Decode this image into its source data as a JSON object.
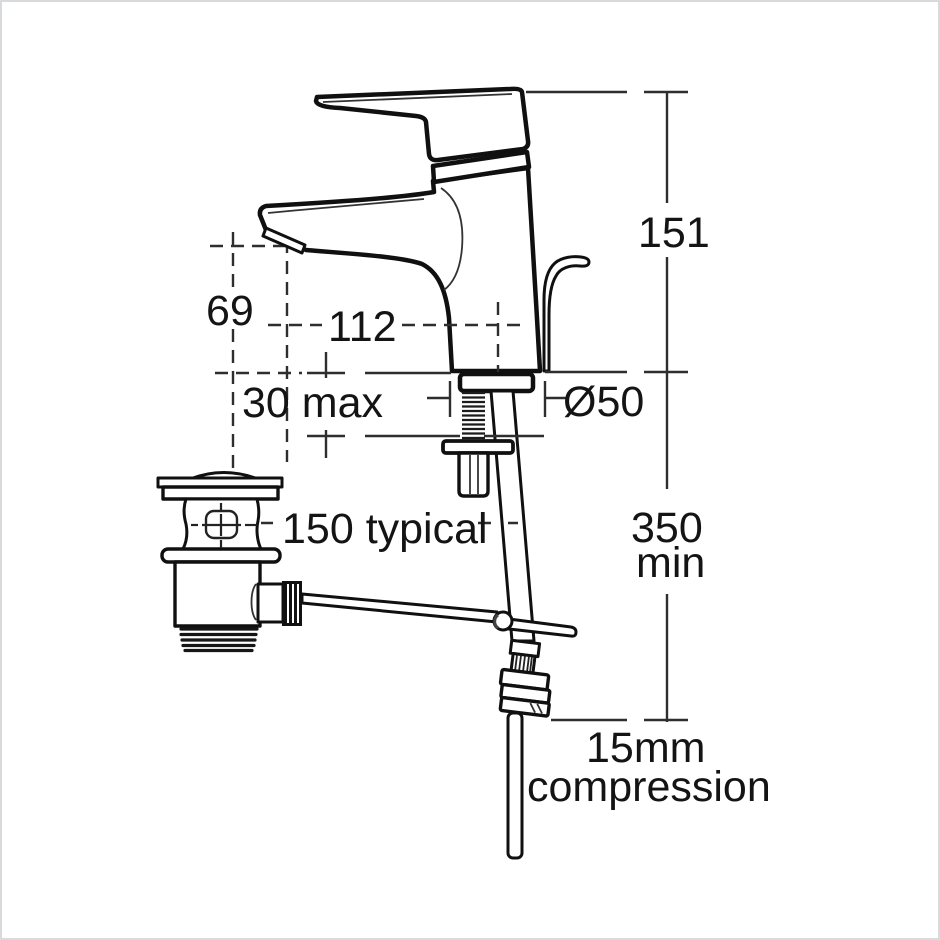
{
  "meta": {
    "title": "Basin mixer tap with pop-up waste - dimensioned technical drawing",
    "background_color": "#ffffff",
    "line_color": "#101010",
    "dimension_line_color": "#2e2e2e",
    "frame_color": "#cdd2d6"
  },
  "diagram": {
    "type": "technical-drawing",
    "components": [
      "single-lever-mixer-tap",
      "pop-up-waste-body",
      "waste-linkage-rod",
      "threaded-shank-and-backnut",
      "flexible-tail-with-compression-fitting",
      "supply-pipe"
    ]
  },
  "dimensions": {
    "overall_height": "151",
    "outlet_height": "69",
    "spout_reach": "112",
    "deck_thickness": "30 max",
    "base_diameter": "Ø50",
    "waste_offset": "150 typical",
    "clearance": [
      "350",
      "min"
    ],
    "connection": [
      "15mm",
      "compression"
    ]
  }
}
